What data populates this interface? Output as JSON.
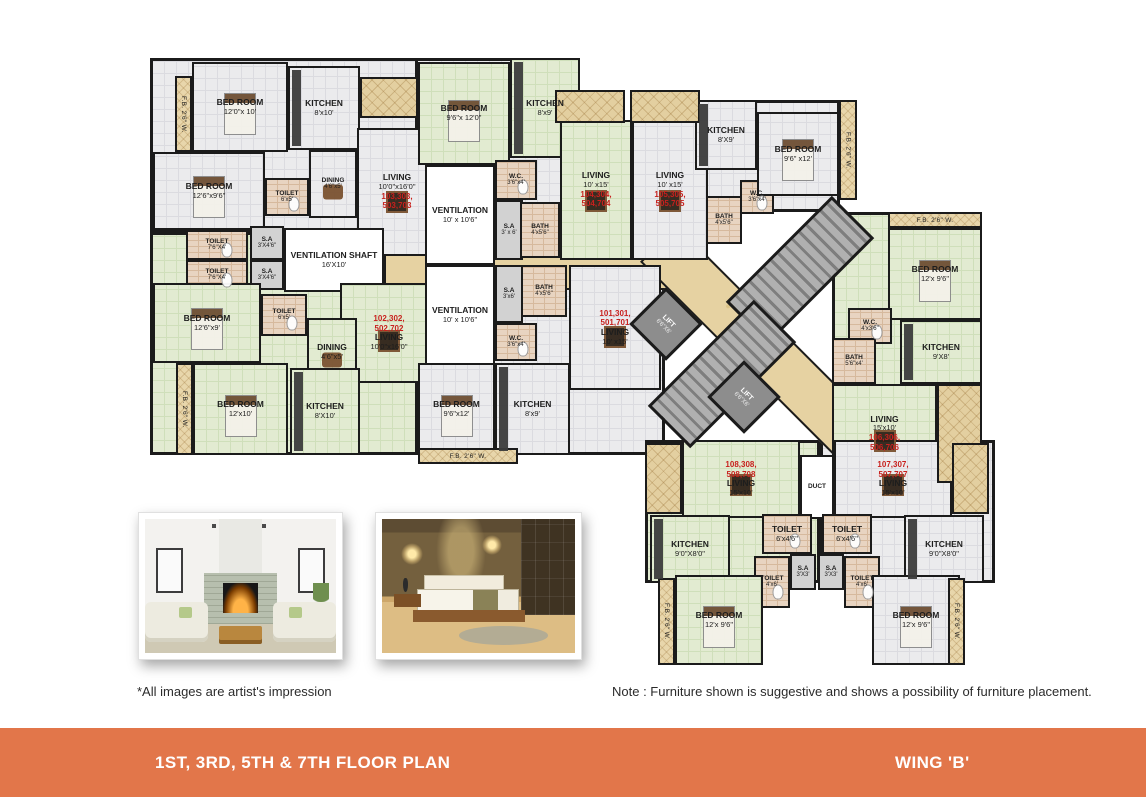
{
  "footer": {
    "left": "1ST, 3RD, 5TH & 7TH FLOOR PLAN",
    "right": "WING 'B'",
    "bg": "#e2764a",
    "text_color": "#ffffff"
  },
  "annotations": {
    "images_note": "*All images are artist's impression",
    "furniture_note": "Note : Furniture shown is suggestive and shows a possibility of furniture placement."
  },
  "colors": {
    "accent_orange": "#e2764a",
    "unit_number_red": "#c8201d",
    "wall": "#1b1b1b",
    "corridor_beige": "#e6d2a2",
    "floor_green": "#e2ebd1",
    "floor_gray": "#ebebed",
    "toilet_tile": "#e8d4c1"
  },
  "photos": [
    {
      "id": "living-room-photo",
      "subject": "living room interior"
    },
    {
      "id": "bedroom-photo",
      "subject": "bedroom interior"
    }
  ],
  "floorplan": {
    "elements": [
      {
        "id": "wing-left-upper",
        "kind": "slab",
        "floor": "gray",
        "x": 150,
        "y": 58,
        "w": 288,
        "h": 174
      },
      {
        "id": "wing-left-lower",
        "kind": "slab",
        "floor": "green",
        "x": 150,
        "y": 232,
        "w": 288,
        "h": 223
      },
      {
        "id": "wing-center-top",
        "kind": "slab",
        "floor": "gray",
        "x": 415,
        "y": 58,
        "w": 165,
        "h": 200
      },
      {
        "id": "wing-top-right",
        "kind": "slab",
        "floor": "gray",
        "x": 695,
        "y": 100,
        "w": 145,
        "h": 112
      },
      {
        "id": "wing-center-bottom",
        "kind": "slab",
        "floor": "gray",
        "x": 415,
        "y": 258,
        "w": 250,
        "h": 197
      },
      {
        "id": "wing-right",
        "kind": "slab",
        "floor": "green",
        "x": 832,
        "y": 212,
        "w": 150,
        "h": 271
      },
      {
        "id": "wing-bottom-left",
        "kind": "slab",
        "floor": "green",
        "x": 645,
        "y": 440,
        "w": 175,
        "h": 143
      },
      {
        "id": "wing-bottom-right",
        "kind": "slab",
        "floor": "gray",
        "x": 820,
        "y": 440,
        "w": 175,
        "h": 143
      },
      {
        "id": "corridor-horizontal",
        "kind": "corridor",
        "x": 384,
        "y": 238,
        "w": 316,
        "h": 52
      },
      {
        "id": "corridor-diagonal",
        "kind": "corridor",
        "x": 613,
        "y": 327,
        "w": 310,
        "h": 52,
        "rot": 45
      },
      {
        "id": "bedroom-103-1",
        "kind": "room",
        "floor": "gray",
        "name": "BED ROOM",
        "dims": "12'0\"x 10'",
        "furn": "bed",
        "x": 192,
        "y": 62,
        "w": 96,
        "h": 90
      },
      {
        "id": "kitchen-103",
        "kind": "room",
        "floor": "gray",
        "name": "KITCHEN",
        "dims": "8'x10'",
        "furn": "counter",
        "x": 288,
        "y": 66,
        "w": 72,
        "h": 84
      },
      {
        "id": "bedroom-103-2",
        "kind": "room",
        "floor": "gray",
        "name": "BED ROOM",
        "dims": "12'6\"x9'6\"",
        "furn": "bed",
        "x": 153,
        "y": 152,
        "w": 112,
        "h": 78
      },
      {
        "id": "toilet-103",
        "kind": "room",
        "floor": "pink",
        "name": "TOILET",
        "dims": "6'x5'",
        "furn": "wc",
        "x": 265,
        "y": 178,
        "w": 44,
        "h": 38
      },
      {
        "id": "dining-103",
        "kind": "room",
        "floor": "gray",
        "name": "DINING",
        "dims": "4'6\"x5'",
        "furn": "table",
        "x": 309,
        "y": 150,
        "w": 48,
        "h": 68
      },
      {
        "id": "living-103",
        "kind": "room",
        "floor": "gray",
        "name": "LIVING",
        "dims": "10'0\"x16'0\"",
        "units": "103,303,\n503,703",
        "upos": "below",
        "furn": "sofa",
        "x": 357,
        "y": 128,
        "w": 80,
        "h": 128
      },
      {
        "id": "toilet-upper-1",
        "kind": "room",
        "floor": "pink",
        "name": "TOILET",
        "dims": "7'6\"X4'",
        "furn": "wc",
        "x": 186,
        "y": 230,
        "w": 62,
        "h": 30
      },
      {
        "id": "sa-upper-1",
        "kind": "room",
        "floor": "gray2",
        "name": "S.A",
        "dims": "3'X4'6\"",
        "x": 250,
        "y": 226,
        "w": 34,
        "h": 34
      },
      {
        "id": "toilet-upper-2",
        "kind": "room",
        "floor": "pink",
        "name": "TOILET",
        "dims": "7'6\"X4'",
        "furn": "wc",
        "x": 186,
        "y": 260,
        "w": 62,
        "h": 30
      },
      {
        "id": "sa-upper-2",
        "kind": "room",
        "floor": "gray2",
        "name": "S.A",
        "dims": "3'X4'6\"",
        "x": 250,
        "y": 260,
        "w": 34,
        "h": 30
      },
      {
        "id": "ventilation-shaft",
        "kind": "room",
        "floor": "white",
        "name": "VENTILATION SHAFT",
        "dims": "16'X10'",
        "x": 284,
        "y": 228,
        "w": 100,
        "h": 64
      },
      {
        "id": "bedroom-102-1",
        "kind": "room",
        "floor": "green",
        "name": "BED ROOM",
        "dims": "12'6\"x9'",
        "furn": "bed",
        "x": 153,
        "y": 283,
        "w": 108,
        "h": 80
      },
      {
        "id": "toilet-102",
        "kind": "room",
        "floor": "pink",
        "name": "TOILET",
        "dims": "6'x5'",
        "furn": "wc",
        "x": 261,
        "y": 294,
        "w": 46,
        "h": 42
      },
      {
        "id": "living-102",
        "kind": "room",
        "floor": "green",
        "name": "LIVING",
        "dims": "10'0\"x16'0\"",
        "units": "102,302,\n502,702",
        "upos": "above",
        "furn": "sofa",
        "x": 340,
        "y": 283,
        "w": 98,
        "h": 100
      },
      {
        "id": "dining-102",
        "kind": "room",
        "floor": "green",
        "name": "DINING",
        "dims": "4'6\"x5'",
        "furn": "table",
        "x": 307,
        "y": 318,
        "w": 50,
        "h": 68
      },
      {
        "id": "kitchen-102",
        "kind": "room",
        "floor": "green",
        "name": "KITCHEN",
        "dims": "8'X10'",
        "furn": "counter",
        "x": 290,
        "y": 368,
        "w": 70,
        "h": 87
      },
      {
        "id": "bedroom-102-2",
        "kind": "room",
        "floor": "green",
        "name": "BED ROOM",
        "dims": "12'x10'",
        "furn": "bed",
        "x": 193,
        "y": 363,
        "w": 95,
        "h": 92
      },
      {
        "id": "bedroom-104",
        "kind": "room",
        "floor": "green",
        "name": "BED ROOM",
        "dims": "9'6\"x 12'0\"",
        "furn": "bed",
        "x": 418,
        "y": 62,
        "w": 92,
        "h": 103
      },
      {
        "id": "kitchen-104",
        "kind": "room",
        "floor": "green",
        "name": "KITCHEN",
        "dims": "8'x9'",
        "furn": "counter",
        "x": 510,
        "y": 58,
        "w": 70,
        "h": 100
      },
      {
        "id": "ventilation-1",
        "kind": "room",
        "floor": "white",
        "name": "VENTILATION",
        "dims": "10' x 10'6\"",
        "x": 425,
        "y": 165,
        "w": 70,
        "h": 100
      },
      {
        "id": "wc-104",
        "kind": "room",
        "floor": "pink",
        "name": "W.C.",
        "dims": "3'6\"x4'",
        "furn": "wc",
        "x": 495,
        "y": 160,
        "w": 42,
        "h": 40
      },
      {
        "id": "sa-104",
        "kind": "room",
        "floor": "gray2",
        "name": "S.A",
        "dims": "3' x 6'",
        "x": 495,
        "y": 200,
        "w": 28,
        "h": 60
      },
      {
        "id": "bath-104",
        "kind": "room",
        "floor": "pink",
        "name": "BATH",
        "dims": "4'x5'6\"",
        "x": 520,
        "y": 202,
        "w": 40,
        "h": 56
      },
      {
        "id": "living-104",
        "kind": "room",
        "floor": "green",
        "name": "LIVING",
        "dims": "10' x15'",
        "units": "104,304,\n504,704",
        "upos": "below",
        "furn": "sofa",
        "x": 560,
        "y": 120,
        "w": 72,
        "h": 140
      },
      {
        "id": "living-105",
        "kind": "room",
        "floor": "gray",
        "name": "LIVING",
        "dims": "10' x15'",
        "units": "105,305,\n505,705",
        "upos": "below",
        "furn": "sofa",
        "x": 632,
        "y": 120,
        "w": 76,
        "h": 140
      },
      {
        "id": "bath-105",
        "kind": "room",
        "floor": "pink",
        "name": "BATH",
        "dims": "4'x5'6\"",
        "x": 706,
        "y": 196,
        "w": 36,
        "h": 48
      },
      {
        "id": "wc-105",
        "kind": "room",
        "floor": "pink",
        "name": "W.C.",
        "dims": "3'6\"x4'",
        "furn": "wc",
        "x": 740,
        "y": 180,
        "w": 34,
        "h": 34
      },
      {
        "id": "kitchen-105",
        "kind": "room",
        "floor": "gray",
        "name": "KITCHEN",
        "dims": "8'X9'",
        "furn": "counter",
        "x": 695,
        "y": 100,
        "w": 62,
        "h": 70
      },
      {
        "id": "bedroom-105",
        "kind": "room",
        "floor": "gray",
        "name": "BED ROOM",
        "dims": "9'6\" x12'",
        "furn": "bed",
        "x": 757,
        "y": 112,
        "w": 82,
        "h": 84
      },
      {
        "id": "ventilation-2",
        "kind": "room",
        "floor": "white",
        "name": "VENTILATION",
        "dims": "10' x 10'6\"",
        "x": 425,
        "y": 265,
        "w": 70,
        "h": 100
      },
      {
        "id": "sa-101",
        "kind": "room",
        "floor": "gray2",
        "name": "S.A",
        "dims": "3'x6'",
        "x": 495,
        "y": 265,
        "w": 28,
        "h": 58
      },
      {
        "id": "bath-101",
        "kind": "room",
        "floor": "pink",
        "name": "BATH",
        "dims": "4'x5'6\"",
        "x": 521,
        "y": 265,
        "w": 46,
        "h": 52
      },
      {
        "id": "living-101",
        "kind": "room",
        "floor": "gray",
        "name": "LIVING",
        "dims": "10' x15'",
        "units": "101,301,\n501,701",
        "upos": "above",
        "furn": "sofa",
        "x": 569,
        "y": 265,
        "w": 92,
        "h": 125
      },
      {
        "id": "wc-101",
        "kind": "room",
        "floor": "pink",
        "name": "W.C.",
        "dims": "3'6\"x4'",
        "furn": "wc",
        "x": 495,
        "y": 323,
        "w": 42,
        "h": 38
      },
      {
        "id": "kitchen-101",
        "kind": "room",
        "floor": "gray",
        "name": "KITCHEN",
        "dims": "8'x9'",
        "furn": "counter",
        "x": 495,
        "y": 363,
        "w": 75,
        "h": 92
      },
      {
        "id": "bedroom-101",
        "kind": "room",
        "floor": "gray",
        "name": "BED ROOM",
        "dims": "9'6\"x12'",
        "furn": "bed",
        "x": 418,
        "y": 363,
        "w": 77,
        "h": 92
      },
      {
        "id": "bedroom-106",
        "kind": "room",
        "floor": "green",
        "name": "BED ROOM",
        "dims": "12'x 9'6\"",
        "furn": "bed",
        "x": 888,
        "y": 228,
        "w": 94,
        "h": 92
      },
      {
        "id": "wc-106",
        "kind": "room",
        "floor": "pink",
        "name": "W.C.",
        "dims": "4'x3'6\"",
        "furn": "wc",
        "x": 848,
        "y": 308,
        "w": 44,
        "h": 36
      },
      {
        "id": "bath-106",
        "kind": "room",
        "floor": "pink",
        "name": "BATH",
        "dims": "5'6\"x4'",
        "x": 832,
        "y": 338,
        "w": 44,
        "h": 46
      },
      {
        "id": "kitchen-106",
        "kind": "room",
        "floor": "green",
        "name": "KITCHEN",
        "dims": "9'X8'",
        "furn": "counter",
        "x": 900,
        "y": 320,
        "w": 82,
        "h": 64
      },
      {
        "id": "living-106",
        "kind": "room",
        "floor": "green",
        "name": "LIVING",
        "dims": "15'x10'",
        "units": "106,306,\n506,706",
        "upos": "below",
        "furn": "sofa",
        "x": 832,
        "y": 384,
        "w": 105,
        "h": 99
      },
      {
        "id": "living-108",
        "kind": "room",
        "floor": "green",
        "name": "LIVING",
        "dims": "15'x10'",
        "units": "108,308,\n508,708",
        "upos": "above",
        "furn": "sofa",
        "x": 682,
        "y": 440,
        "w": 118,
        "h": 78
      },
      {
        "id": "duct",
        "kind": "room",
        "floor": "white",
        "name": "DUCT",
        "x": 800,
        "y": 455,
        "w": 34,
        "h": 64
      },
      {
        "id": "living-107",
        "kind": "room",
        "floor": "gray",
        "name": "LIVING",
        "dims": "15'x10'",
        "units": "107,307,\n507,707",
        "upos": "above",
        "furn": "sofa",
        "x": 834,
        "y": 440,
        "w": 118,
        "h": 78
      },
      {
        "id": "kitchen-108",
        "kind": "room",
        "floor": "green",
        "name": "KITCHEN",
        "dims": "9'0\"X8'0\"",
        "furn": "counter",
        "x": 650,
        "y": 515,
        "w": 80,
        "h": 68
      },
      {
        "id": "toilet-108-1",
        "kind": "room",
        "floor": "pink",
        "name": "TOILET",
        "dims": "6'x4'6\"",
        "furn": "wc",
        "x": 762,
        "y": 514,
        "w": 50,
        "h": 40
      },
      {
        "id": "toilet-107-1",
        "kind": "room",
        "floor": "pink",
        "name": "TOILET",
        "dims": "6'x4'6\"",
        "furn": "wc",
        "x": 822,
        "y": 514,
        "w": 50,
        "h": 40
      },
      {
        "id": "sa-108",
        "kind": "room",
        "floor": "gray2",
        "name": "S.A",
        "dims": "3'X3'",
        "x": 790,
        "y": 554,
        "w": 26,
        "h": 36
      },
      {
        "id": "sa-107",
        "kind": "room",
        "floor": "gray2",
        "name": "S.A",
        "dims": "3'X3'",
        "x": 818,
        "y": 554,
        "w": 26,
        "h": 36
      },
      {
        "id": "toilet-108-2",
        "kind": "room",
        "floor": "pink",
        "name": "TOILET",
        "dims": "4'x6'",
        "furn": "wc",
        "x": 754,
        "y": 556,
        "w": 36,
        "h": 52
      },
      {
        "id": "toilet-107-2",
        "kind": "room",
        "floor": "pink",
        "name": "TOILET",
        "dims": "4'x6'",
        "furn": "wc",
        "x": 844,
        "y": 556,
        "w": 36,
        "h": 52
      },
      {
        "id": "bedroom-108",
        "kind": "room",
        "floor": "green",
        "name": "BED ROOM",
        "dims": "12'x 9'6\"",
        "furn": "bed",
        "x": 675,
        "y": 575,
        "w": 88,
        "h": 90
      },
      {
        "id": "kitchen-107",
        "kind": "room",
        "floor": "gray",
        "name": "KITCHEN",
        "dims": "9'0\"X8'0\"",
        "furn": "counter",
        "x": 904,
        "y": 515,
        "w": 80,
        "h": 68
      },
      {
        "id": "bedroom-107",
        "kind": "room",
        "floor": "gray",
        "name": "BED ROOM",
        "dims": "12'x 9'6\"",
        "furn": "bed",
        "x": 872,
        "y": 575,
        "w": 88,
        "h": 90
      },
      {
        "id": "staircase-1",
        "kind": "stair",
        "x": 725,
        "y": 240,
        "w": 150,
        "h": 60,
        "rot": -45
      },
      {
        "id": "staircase-2",
        "kind": "stair",
        "x": 647,
        "y": 344,
        "w": 150,
        "h": 60,
        "rot": -45
      },
      {
        "id": "lift-1",
        "kind": "lift",
        "name": "LIFT",
        "dims": "6'6\"X6'",
        "x": 640,
        "y": 298,
        "w": 52,
        "h": 52,
        "rot": 45
      },
      {
        "id": "lift-2",
        "kind": "lift",
        "name": "LIFT",
        "dims": "6'6\"X6'",
        "x": 718,
        "y": 371,
        "w": 52,
        "h": 52,
        "rot": 45
      },
      {
        "id": "balcony-103",
        "kind": "deco",
        "x": 360,
        "y": 77,
        "w": 58,
        "h": 41
      },
      {
        "id": "balcony-104",
        "kind": "deco",
        "x": 555,
        "y": 90,
        "w": 70,
        "h": 33
      },
      {
        "id": "balcony-105",
        "kind": "deco",
        "x": 630,
        "y": 90,
        "w": 70,
        "h": 33
      },
      {
        "id": "sitout-106",
        "kind": "deco",
        "x": 937,
        "y": 384,
        "w": 45,
        "h": 99
      },
      {
        "id": "flowerbed-108",
        "kind": "deco",
        "x": 645,
        "y": 443,
        "w": 37,
        "h": 71
      },
      {
        "id": "flowerbed-107",
        "kind": "deco",
        "x": 952,
        "y": 443,
        "w": 37,
        "h": 71
      },
      {
        "id": "fb-left-top",
        "kind": "fb",
        "orient": "v",
        "text": "F.B. 2'6\" W.",
        "x": 175,
        "y": 76,
        "w": 17,
        "h": 76
      },
      {
        "id": "fb-left-bottom",
        "kind": "fb",
        "orient": "v",
        "text": "F.B. 2'6\" W.",
        "x": 176,
        "y": 363,
        "w": 17,
        "h": 92
      },
      {
        "id": "fb-top-right",
        "kind": "fb",
        "orient": "v",
        "text": "F.B. 2'6\" W.",
        "x": 839,
        "y": 100,
        "w": 18,
        "h": 100
      },
      {
        "id": "fb-center-bottom",
        "kind": "fb",
        "orient": "h",
        "text": "F.B. 2'6\" W.",
        "x": 418,
        "y": 448,
        "w": 100,
        "h": 16
      },
      {
        "id": "fb-right-top",
        "kind": "fb",
        "orient": "h",
        "text": "F.B. 2'6\" W.",
        "x": 888,
        "y": 212,
        "w": 94,
        "h": 16
      },
      {
        "id": "fb-bottom-left",
        "kind": "fb",
        "orient": "v",
        "text": "F.B. 2'6\" W.",
        "x": 658,
        "y": 578,
        "w": 17,
        "h": 87
      },
      {
        "id": "fb-bottom-right",
        "kind": "fb",
        "orient": "v",
        "text": "F.B. 2'6\" W.",
        "x": 948,
        "y": 578,
        "w": 17,
        "h": 87
      }
    ]
  }
}
